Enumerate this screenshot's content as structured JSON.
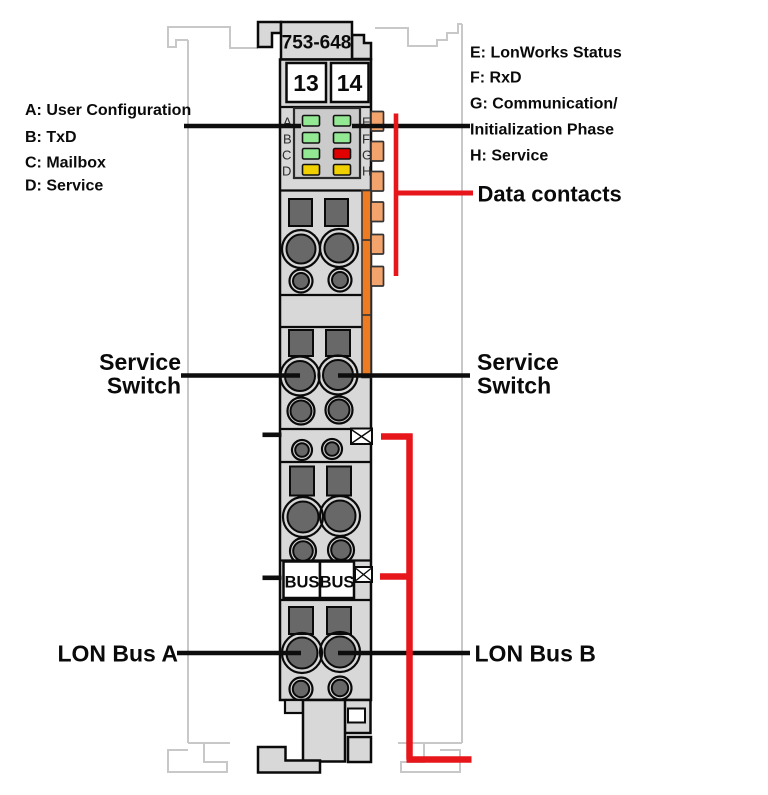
{
  "colors": {
    "body": "#d8d8d8",
    "panel": "#cbcbcb",
    "slot": "#686868",
    "ghost": "#c8c8c8",
    "ink": "#0a0a0a",
    "white": "#ffffff",
    "orange_strip": "#ed7b21",
    "orange_tab": "#f3a46c",
    "led_green": "#93e893",
    "led_red": "#e00000",
    "led_yellow": "#f0d000",
    "callout_red": "#e6161b"
  },
  "module": {
    "part_number": "753-648",
    "terminal_numbers": [
      "13",
      "14"
    ],
    "bus_labels": [
      "BUS",
      "BUS"
    ],
    "led_letters_left": [
      "A",
      "B",
      "C",
      "D"
    ],
    "led_letters_right": [
      "E",
      "F",
      "G",
      "H"
    ],
    "led_states": {
      "A": "green",
      "B": "green",
      "C": "green",
      "D": "yellow",
      "E": "green",
      "F": "green",
      "G": "red",
      "H": "yellow"
    }
  },
  "legend": {
    "left": [
      "A: User Configuration",
      "B: TxD",
      "C: Mailbox",
      "D: Service"
    ],
    "right": [
      "E: LonWorks Status",
      "F: RxD",
      "G: Communication/",
      "Initialization Phase",
      "H: Service"
    ]
  },
  "callouts": {
    "data_contacts": "Data contacts",
    "service_switch": [
      "Service",
      "Switch"
    ],
    "lon_bus_a": "LON Bus A",
    "lon_bus_b": "LON Bus B"
  }
}
